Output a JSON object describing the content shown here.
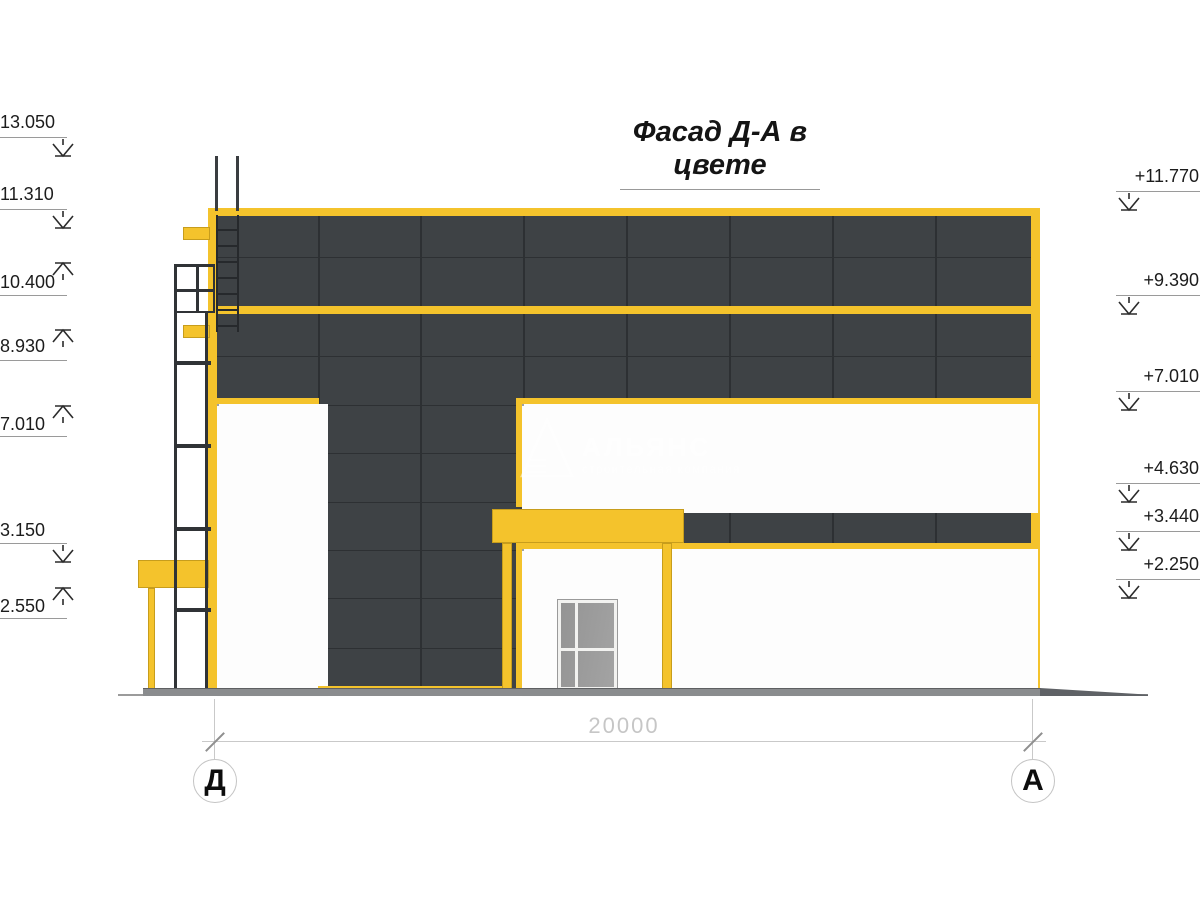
{
  "title": "Фасад Д-А в цвете",
  "watermark": {
    "name": "АЛЬЯНС",
    "subtitle": "строительная компания"
  },
  "axes": {
    "left_label": "Д",
    "right_label": "А",
    "span_dimension": "20000"
  },
  "marks": {
    "left": [
      {
        "value": "13.050",
        "dir": "down"
      },
      {
        "value": "11.310",
        "dir": "down"
      },
      {
        "value": "10.400",
        "dir": "up"
      },
      {
        "value": "8.930",
        "dir": "up"
      },
      {
        "value": "7.010",
        "dir": "up"
      },
      {
        "value": "3.150",
        "dir": "down"
      },
      {
        "value": "2.550",
        "dir": "up"
      }
    ],
    "right": [
      {
        "value": "+11.770",
        "dir": "down"
      },
      {
        "value": "+9.390",
        "dir": "down"
      },
      {
        "value": "+7.010",
        "dir": "down"
      },
      {
        "value": "+4.630",
        "dir": "down"
      },
      {
        "value": "+3.440",
        "dir": "down"
      },
      {
        "value": "+2.250",
        "dir": "down"
      }
    ]
  },
  "glazing": {
    "upper_band": {
      "cols": 10,
      "rows": 2
    },
    "lower_band": {
      "cols": 10,
      "rows": 3
    },
    "left_block": {
      "cols": 2,
      "rows": 6
    }
  },
  "colors": {
    "accent_yellow": "#F4C32C",
    "facade_dark": "#3E4245",
    "glass_light": "#F6F6F4",
    "glass_dark": "#8F8F8F",
    "ground_gray": "#8A8C8E"
  }
}
